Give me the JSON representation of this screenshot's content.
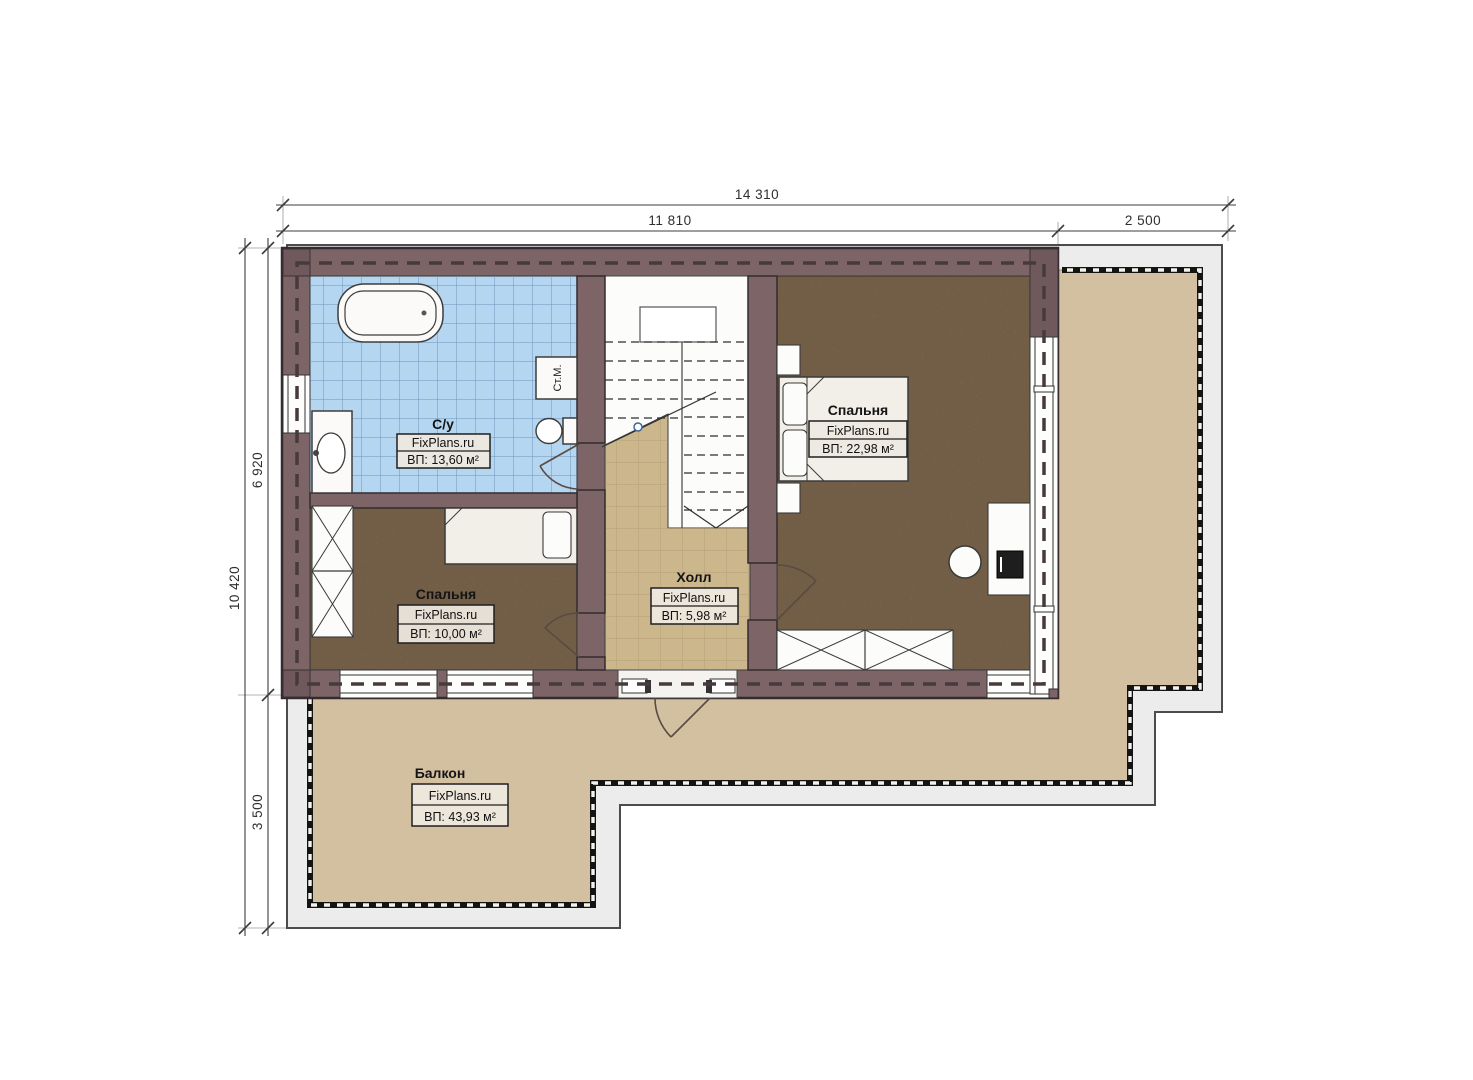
{
  "title": "Floor plan with balcony (FixPlans.ru)",
  "dimensions": {
    "top_total": "14 310",
    "top_main": "11 810",
    "top_terrace": "2 500",
    "left_total": "10 420",
    "left_upper": "6 920",
    "left_lower": "3 500"
  },
  "rooms": [
    {
      "id": "bathroom",
      "name": "С/у",
      "brand": "FixPlans.ru",
      "area": "ВП: 13,60 м²"
    },
    {
      "id": "bedroom-right",
      "name": "Спальня",
      "brand": "FixPlans.ru",
      "area": "ВП: 22,98 м²"
    },
    {
      "id": "bedroom-left",
      "name": "Спальня",
      "brand": "FixPlans.ru",
      "area": "ВП: 10,00 м²"
    },
    {
      "id": "hall",
      "name": "Холл",
      "brand": "FixPlans.ru",
      "area": "ВП: 5,98 м²"
    },
    {
      "id": "balcony",
      "name": "Балкон",
      "brand": "FixPlans.ru",
      "area": "ВП: 43,93 м²"
    }
  ],
  "fixtures": {
    "washing_machine": "Ст.М."
  },
  "colors": {
    "wall": "#7d6567",
    "bathroom_tile": "#b4d6f1",
    "wood_floor": "#8c7457",
    "hall_tile": "#ccb78c",
    "balcony_floor": "#d3c0a0",
    "terrace_slab": "#ececec"
  }
}
